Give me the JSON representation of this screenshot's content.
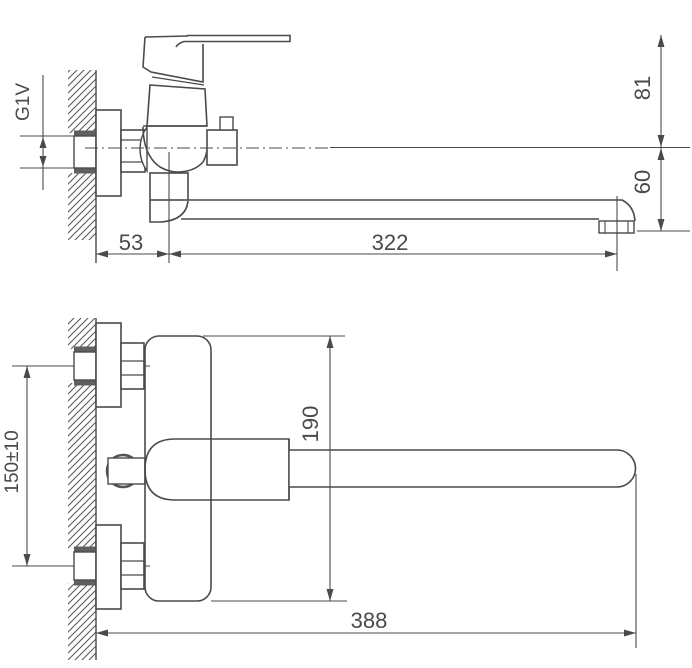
{
  "drawing": {
    "description": "Dimensioned technical drawing of a wall-mounted single-lever bath mixer with long straight spout, side view above and front view below",
    "background_color": "#ffffff",
    "line_color": "#4a4a4a",
    "shading_color": "#5f5f5f"
  },
  "dims": {
    "thread": "G1V",
    "offset": "53",
    "reach": "322",
    "upper_height": "81",
    "spout_drop": "60",
    "body_height": "190",
    "inlet_spacing": "150±10",
    "total_reach": "388"
  }
}
